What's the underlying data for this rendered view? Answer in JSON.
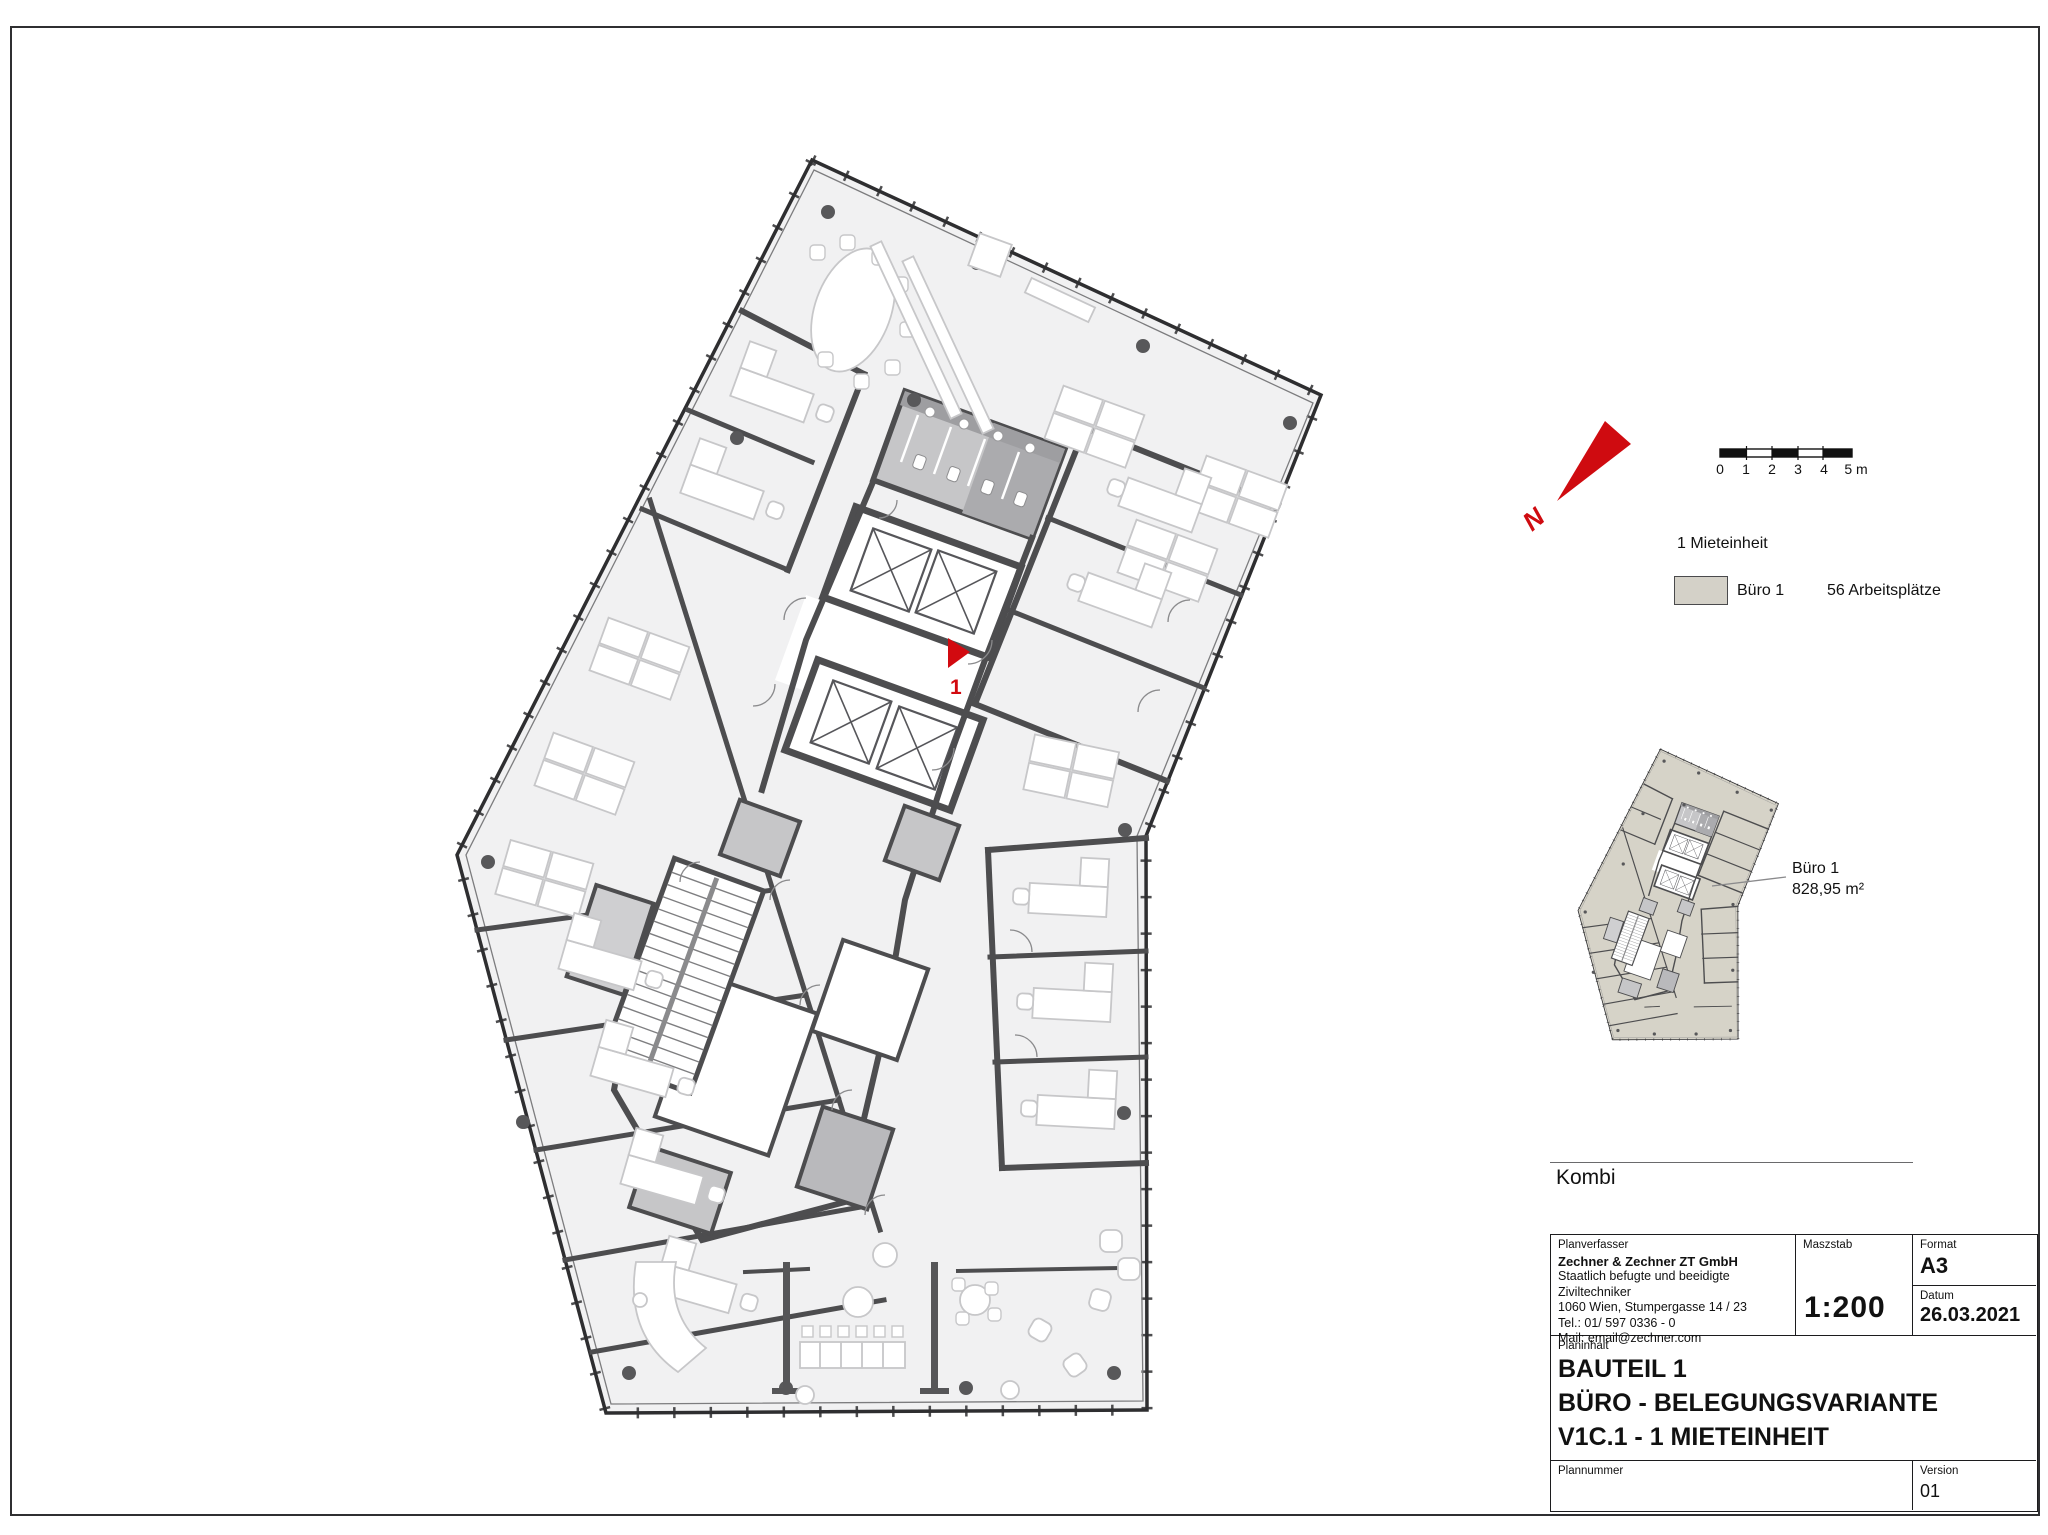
{
  "north": {
    "label": "N",
    "color": "#cf0b10"
  },
  "scale_bar": {
    "labels": [
      "0",
      "1",
      "2",
      "3",
      "4",
      "5 m"
    ]
  },
  "legend": {
    "title": "1 Mieteinheit",
    "item_label": "Büro 1",
    "item_value": "56 Arbeitsplätze",
    "swatch_color": "#d4d1c8"
  },
  "mini_plan": {
    "callout_line1": "Büro 1",
    "callout_line2": "828,95 m²"
  },
  "plan": {
    "unit_marker": "1",
    "marker_color": "#d20a10"
  },
  "kombi_label": "Kombi",
  "title_block": {
    "planverfasser_label": "Planverfasser",
    "company": "Zechner & Zechner ZT GmbH",
    "company_line2": "Staatlich befugte und beeidigte Ziviltechniker",
    "address": "1060 Wien, Stumpergasse 14 / 23",
    "tel": "Tel.: 01/ 597 0336 - 0",
    "mail": "Mail: email@zechner.com",
    "maszstab_label": "Maszstab",
    "maszstab_value": "1:200",
    "format_label": "Format",
    "format_value": "A3",
    "datum_label": "Datum",
    "datum_value": "26.03.2021",
    "planinhalt_label": "Planinhalt",
    "planinhalt_line1": "BAUTEIL 1",
    "planinhalt_line2": "BÜRO - BELEGUNGSVARIANTE",
    "planinhalt_line3": "V1C.1 - 1  MIETEINHEIT",
    "plannummer_label": "Plannummer",
    "plannummer_value": "",
    "version_label": "Version",
    "version_value": "01"
  }
}
